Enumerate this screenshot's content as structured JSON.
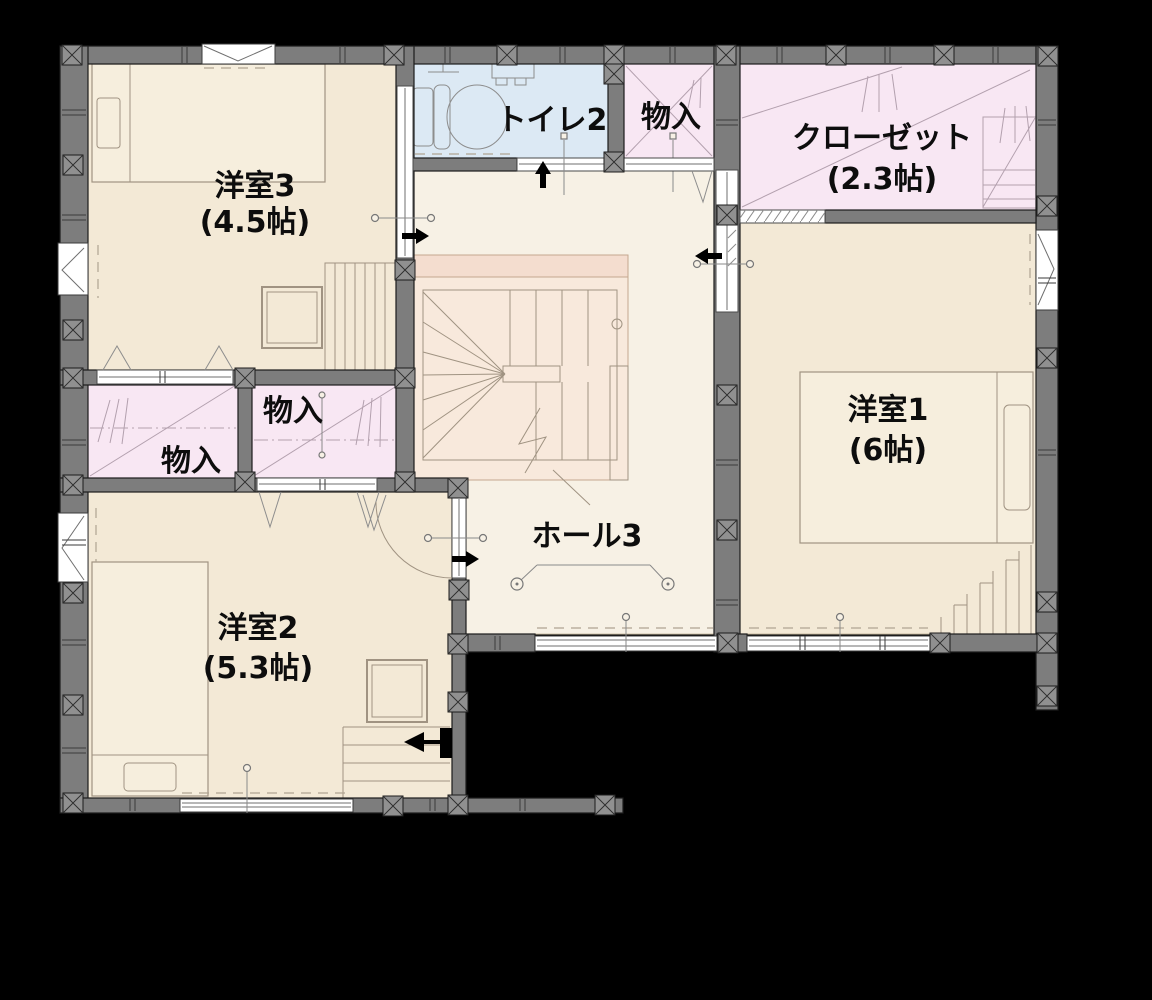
{
  "plan": {
    "floor_note": "2F floor plan on black background",
    "rooms": {
      "yoshitsu3": {
        "label": "洋室3",
        "size": "(4.5帖)"
      },
      "toilet2": {
        "label": "トイレ2"
      },
      "monoire_top": {
        "label": "物入"
      },
      "closet": {
        "label": "クローゼット",
        "size": "(2.3帖)"
      },
      "yoshitsu1": {
        "label": "洋室1",
        "size": "(6帖)"
      },
      "monoire_right": {
        "label": "物入"
      },
      "monoire_left": {
        "label": "物入"
      },
      "yoshitsu2": {
        "label": "洋室2",
        "size": "(5.3帖)"
      },
      "hall3": {
        "label": "ホール3"
      }
    }
  },
  "colors": {
    "bg": "#000000",
    "wall": "#7d7d7d",
    "pillar": "#909090",
    "room": "#f3e9d6",
    "hall": "#f7f1e5",
    "storage": "#f8e7f3",
    "toilet": "#dce9f4",
    "stairs": "#f8e9dc",
    "window": "#ffffff",
    "text": "#0d0d0d"
  }
}
